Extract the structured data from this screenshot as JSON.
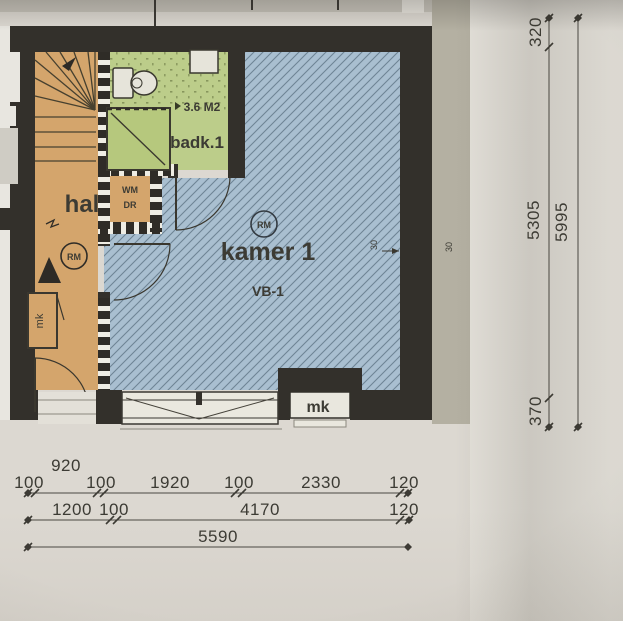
{
  "drawing": {
    "type": "architectural floor plan photo",
    "rooms": {
      "hall": {
        "label": "hal"
      },
      "bathroom": {
        "label": "badk.1",
        "area": "3.6 M2"
      },
      "room1": {
        "label": "kamer 1",
        "code": "VB-1"
      },
      "closet": {
        "line1": "WM",
        "line2": "DR"
      },
      "meter_cabinet_hall": {
        "label": "mk"
      },
      "meter_cabinet_facade": {
        "label": "mk"
      },
      "smoke_detector_hall": {
        "label": "RM"
      },
      "smoke_detector_room": {
        "label": "RM"
      },
      "door_mark": {
        "label": "S"
      }
    },
    "dimensions": {
      "horizontal_row1_overall": "920",
      "horizontal_row1": [
        "100",
        "100",
        "1920",
        "100",
        "2330",
        "120"
      ],
      "horizontal_row2": [
        "1200",
        "100",
        "4170",
        "120"
      ],
      "horizontal_row3": "5590",
      "vertical_inner": [
        "320",
        "5305",
        "370"
      ],
      "vertical_outer": "5995",
      "wall_note_inner": "30",
      "wall_note_outer": "30"
    },
    "colors": {
      "paper": "#dcd8d1",
      "wall": "#33302b",
      "hall_fill": "#d4a56c",
      "bath_fill": "#bccd8a",
      "room_fill": "#a9bfd0",
      "hatch_line": "#50697d",
      "side_band": "#b4b0a2",
      "ink": "#3c3b34"
    }
  }
}
